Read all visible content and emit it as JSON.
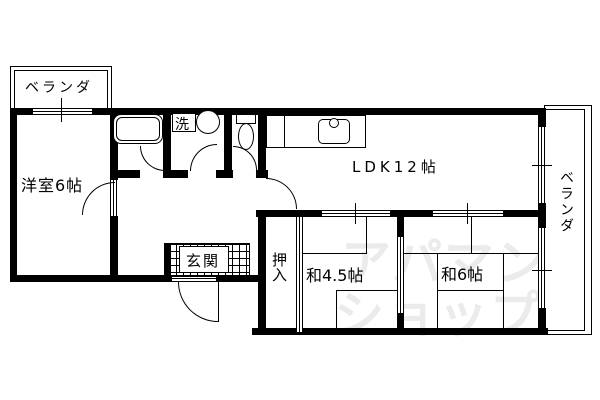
{
  "rooms": {
    "balcony_top": {
      "label": "ベランダ"
    },
    "western": {
      "label": "洋室6帖"
    },
    "laundry": {
      "label": "洗"
    },
    "ldk": {
      "label": "LDK12帖"
    },
    "balcony_right": {
      "label": "ベランダ"
    },
    "entrance": {
      "label": "玄関"
    },
    "closet": {
      "label": "押入"
    },
    "japanese45": {
      "label": "和4.5帖"
    },
    "japanese6": {
      "label": "和6帖"
    }
  },
  "watermark": {
    "line1": "アパマン",
    "line2": "ショップ"
  },
  "colors": {
    "wall": "#000000",
    "background": "#ffffff",
    "watermark": "#ebebeb"
  },
  "icons": {
    "bathtub": "bathtub-icon",
    "washing_machine": "washing-machine-icon",
    "toilet": "toilet-icon",
    "kitchen_sink": "kitchen-sink-icon"
  }
}
